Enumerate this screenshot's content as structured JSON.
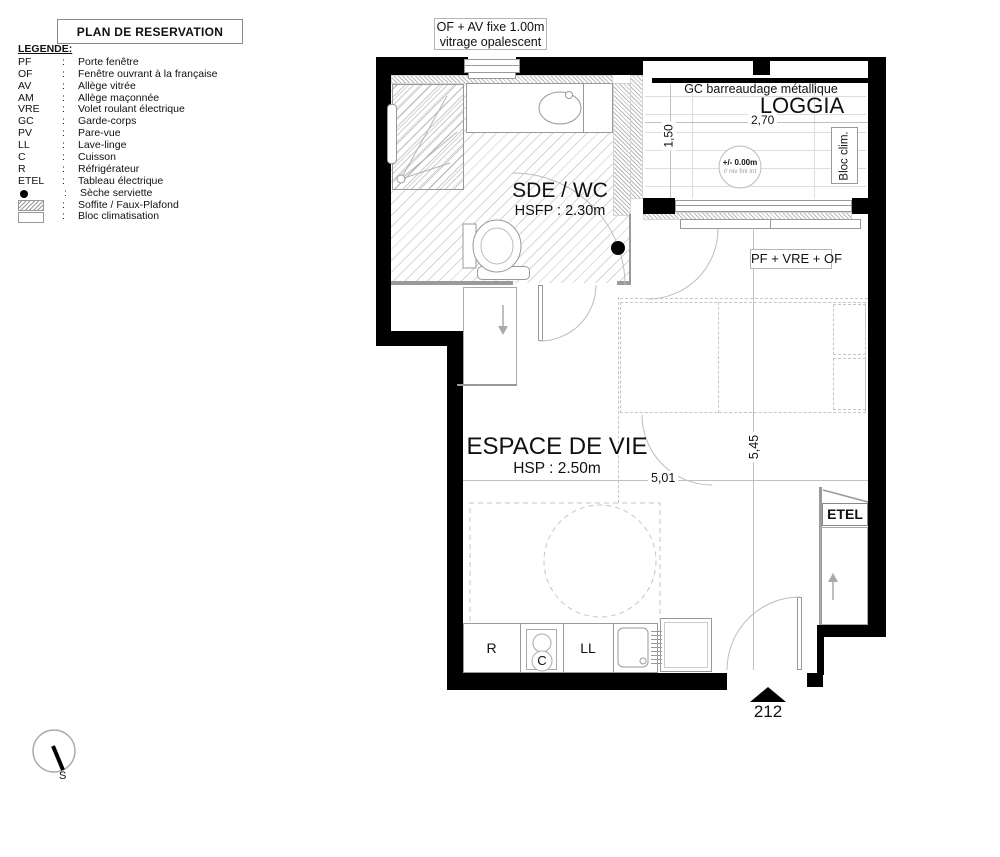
{
  "colors": {
    "wall": "#000000",
    "thin_line": "#9a9a9a",
    "dashed_line": "#c6c6c6"
  },
  "title_block": {
    "title": "PLAN DE RESERVATION"
  },
  "legend": {
    "heading": "LEGENDE:",
    "colon": ":",
    "items": [
      {
        "abbr": "PF",
        "label": "Porte fenêtre"
      },
      {
        "abbr": "OF",
        "label": "Fenêtre ouvrant à la française"
      },
      {
        "abbr": "AV",
        "label": "Allège vitrée"
      },
      {
        "abbr": "AM",
        "label": "Allège maçonnée"
      },
      {
        "abbr": "VRE",
        "label": "Volet roulant électrique"
      },
      {
        "abbr": "GC",
        "label": "Garde-corps"
      },
      {
        "abbr": "PV",
        "label": "Pare-vue"
      },
      {
        "abbr": "LL",
        "label": "Lave-linge"
      },
      {
        "abbr": "C",
        "label": "Cuisson"
      },
      {
        "abbr": "R",
        "label": "Réfrigérateur"
      },
      {
        "abbr": "ETEL",
        "label": "Tableau électrique"
      },
      {
        "abbr": "●",
        "label": "Sèche serviette",
        "swatch": "dot"
      },
      {
        "abbr": "",
        "label": "Soffite / Faux-Plafond",
        "swatch": "hatch"
      },
      {
        "abbr": "",
        "label": "Bloc climatisation",
        "swatch": "box"
      }
    ]
  },
  "plan": {
    "window_note": {
      "line1": "OF + AV fixe 1.00m",
      "line2": "vitrage opalescent"
    },
    "loggia": {
      "gc_note": "GC barreaudage métallique",
      "name": "LOGGIA",
      "width": "2,70",
      "depth": "1,50",
      "bloc_clim": "Bloc clim.",
      "level": "+/- 0.00m",
      "level_sub": "// niv fini int"
    },
    "sde_wc": {
      "name": "SDE / WC",
      "height": "HSFP : 2.30m"
    },
    "living": {
      "name": "ESPACE DE VIE",
      "height": "HSP : 2.50m",
      "width": "5,01",
      "depth": "5,45",
      "window_note": "PF + VRE + OF"
    },
    "kitchen": {
      "fridge": "R",
      "cooktop": "C",
      "washer": "LL"
    },
    "etel_label": "ETEL",
    "unit_number": "212",
    "compass": {
      "south": "S"
    }
  }
}
